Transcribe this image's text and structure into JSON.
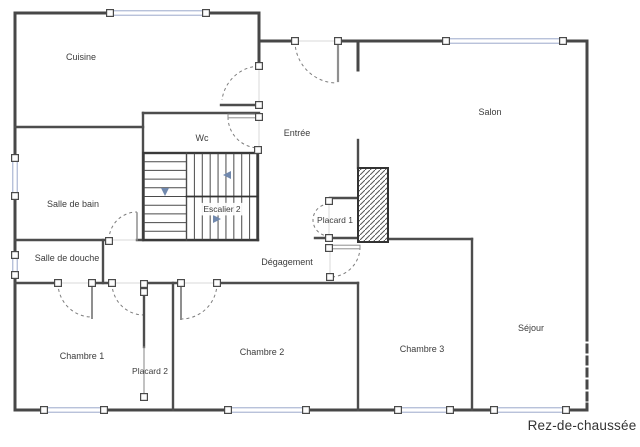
{
  "floor_label": "Rez-de-chaussée",
  "rooms": [
    {
      "name": "Cuisine",
      "x": 81,
      "y": 57,
      "fs": 9
    },
    {
      "name": "Wc",
      "x": 202,
      "y": 138,
      "fs": 9
    },
    {
      "name": "Entrée",
      "x": 297,
      "y": 133,
      "fs": 9
    },
    {
      "name": "Salon",
      "x": 490,
      "y": 112,
      "fs": 9
    },
    {
      "name": "Salle de bain",
      "x": 73,
      "y": 204,
      "fs": 9
    },
    {
      "name": "Escalier 2",
      "x": 222,
      "y": 209,
      "fs": 8.5,
      "bg": true
    },
    {
      "name": "Placard 1",
      "x": 335,
      "y": 220,
      "fs": 8.5
    },
    {
      "name": "Salle de douche",
      "x": 67,
      "y": 258,
      "fs": 9
    },
    {
      "name": "Dégagement",
      "x": 287,
      "y": 262,
      "fs": 9
    },
    {
      "name": "Chambre 1",
      "x": 82,
      "y": 356,
      "fs": 9
    },
    {
      "name": "Placard 2",
      "x": 150,
      "y": 371,
      "fs": 8.5
    },
    {
      "name": "Chambre 2",
      "x": 262,
      "y": 352,
      "fs": 9
    },
    {
      "name": "Chambre 3",
      "x": 422,
      "y": 349,
      "fs": 9
    },
    {
      "name": "Séjour",
      "x": 531,
      "y": 328,
      "fs": 9
    }
  ],
  "colors": {
    "wall": "#474747",
    "inner_wall": "#4d4d4d",
    "window": "#9ba9cb",
    "arc": "#7d7d7d",
    "leaf": "#8f8f8f",
    "leaf_dark": "#3f3f3f",
    "opening": "#d9d9d9",
    "square_border": "#4a4a4a",
    "text": "#3c3c3c",
    "arrow": "#7189ae",
    "tread": "#4a4a4a",
    "hatch": "#555555"
  },
  "plan": {
    "walls_outer": [
      [
        15,
        13,
        110,
        13
      ],
      [
        206,
        13,
        259,
        13
      ],
      [
        15,
        13,
        15,
        158
      ],
      [
        15,
        196,
        15,
        255
      ],
      [
        15,
        275,
        15,
        410
      ],
      [
        15,
        410,
        44,
        410
      ],
      [
        104,
        410,
        228,
        410
      ],
      [
        306,
        410,
        398,
        410
      ],
      [
        450,
        410,
        494,
        410
      ],
      [
        566,
        410,
        587,
        410
      ],
      [
        587,
        41,
        587,
        333
      ],
      [
        587,
        404,
        587,
        410
      ],
      [
        259,
        13,
        259,
        66
      ],
      [
        259,
        41,
        295,
        41
      ],
      [
        337,
        41,
        446,
        41
      ],
      [
        563,
        41,
        587,
        41
      ],
      [
        358,
        41,
        358,
        70
      ]
    ],
    "walls_dashed": [
      [
        587,
        333,
        587,
        404
      ]
    ],
    "walls_inner": [
      [
        15,
        127,
        143,
        127
      ],
      [
        143,
        113,
        143,
        240
      ],
      [
        143,
        113,
        259,
        113
      ],
      [
        258,
        150,
        258,
        240
      ],
      [
        15,
        240,
        109,
        240
      ],
      [
        137,
        240,
        258,
        240
      ],
      [
        103,
        240,
        103,
        283
      ],
      [
        15,
        283,
        58,
        283
      ],
      [
        92,
        283,
        112,
        283
      ],
      [
        144,
        283,
        181,
        283
      ],
      [
        217,
        283,
        358,
        283
      ],
      [
        173,
        283,
        173,
        410
      ],
      [
        358,
        283,
        358,
        410
      ],
      [
        388,
        239,
        472,
        239
      ],
      [
        472,
        239,
        472,
        410
      ],
      [
        330,
        198,
        358,
        198
      ],
      [
        315,
        238,
        358,
        238
      ],
      [
        358,
        140,
        358,
        168
      ],
      [
        144,
        292,
        144,
        347
      ],
      [
        221,
        105,
        259,
        105
      ]
    ],
    "walls_thin": [
      [
        144,
        347,
        144,
        397
      ]
    ],
    "openings": [
      [
        295,
        41,
        337,
        41
      ],
      [
        259,
        66,
        259,
        105
      ],
      [
        259,
        119,
        259,
        148
      ],
      [
        109,
        240,
        137,
        240
      ],
      [
        58,
        283,
        92,
        283
      ],
      [
        112,
        283,
        144,
        283
      ],
      [
        181,
        283,
        217,
        283
      ],
      [
        330,
        249,
        330,
        275
      ],
      [
        329,
        205,
        329,
        235
      ]
    ],
    "door_arcs": [
      "M295,41 A42,42 0 0 0 337,83",
      "M259,66 A39,39 0 0 0 222,100",
      "M228,117 A31,31 0 0 0 259,148",
      "M109,240 A28,28 0 0 1 137,212",
      "M58,283 A34,34 0 0 0 92,317",
      "M112,283 A32,32 0 0 0 144,315",
      "M217,283 A36,36 0 0 1 181,319",
      "M360,247 A30,30 0 0 1 330,277",
      "M329,204 A16,16 0 0 0 329,236"
    ],
    "leaves_single": [
      [
        338,
        44,
        338,
        81,
        2.2
      ],
      [
        137,
        213,
        137,
        240,
        1.5
      ],
      [
        92,
        285,
        92,
        318,
        2
      ],
      [
        181,
        285,
        181,
        319,
        2
      ]
    ],
    "leaves_double": [
      [
        228,
        114.2,
        31,
        3.6
      ],
      [
        331,
        245.2,
        29,
        3.6
      ]
    ],
    "windows": [
      [
        110,
        13,
        206,
        13
      ],
      [
        446,
        41,
        563,
        41
      ],
      [
        15,
        158,
        15,
        196
      ],
      [
        15,
        255,
        15,
        275
      ],
      [
        44,
        410,
        104,
        410
      ],
      [
        228,
        410,
        306,
        410
      ],
      [
        398,
        410,
        450,
        410
      ],
      [
        494,
        410,
        566,
        410
      ]
    ],
    "squares": [
      [
        295,
        41
      ],
      [
        338,
        41
      ],
      [
        259,
        66
      ],
      [
        259,
        105
      ],
      [
        259,
        117
      ],
      [
        258,
        150
      ],
      [
        109,
        241
      ],
      [
        58,
        283
      ],
      [
        92,
        283
      ],
      [
        112,
        283
      ],
      [
        144,
        284
      ],
      [
        144,
        292
      ],
      [
        181,
        283
      ],
      [
        217,
        283
      ],
      [
        329,
        201
      ],
      [
        329,
        238
      ],
      [
        329,
        248
      ],
      [
        330,
        277
      ],
      [
        144,
        397
      ],
      [
        110,
        13
      ],
      [
        206,
        13
      ],
      [
        446,
        41
      ],
      [
        563,
        41
      ],
      [
        15,
        158
      ],
      [
        15,
        196
      ],
      [
        15,
        255
      ],
      [
        15,
        275
      ],
      [
        44,
        410
      ],
      [
        104,
        410
      ],
      [
        228,
        410
      ],
      [
        306,
        410
      ],
      [
        398,
        410
      ],
      [
        450,
        410
      ],
      [
        494,
        410
      ],
      [
        566,
        410
      ]
    ],
    "hatch_rect": {
      "x": 358,
      "y": 168,
      "w": 30,
      "h": 74
    },
    "stairs": {
      "x": 143.5,
      "y": 153,
      "w": 114,
      "h": 87,
      "col_split": 186.5,
      "row_split": 196.5,
      "left_treads_n": 9,
      "right_treads_n": 8,
      "arrows": [
        {
          "dir": "down",
          "pts": "161,188 169,188 165,196"
        },
        {
          "dir": "left",
          "pts": "231,171 231,179 223,175"
        },
        {
          "dir": "right",
          "pts": "213,215 213,223 221,219"
        }
      ]
    }
  }
}
